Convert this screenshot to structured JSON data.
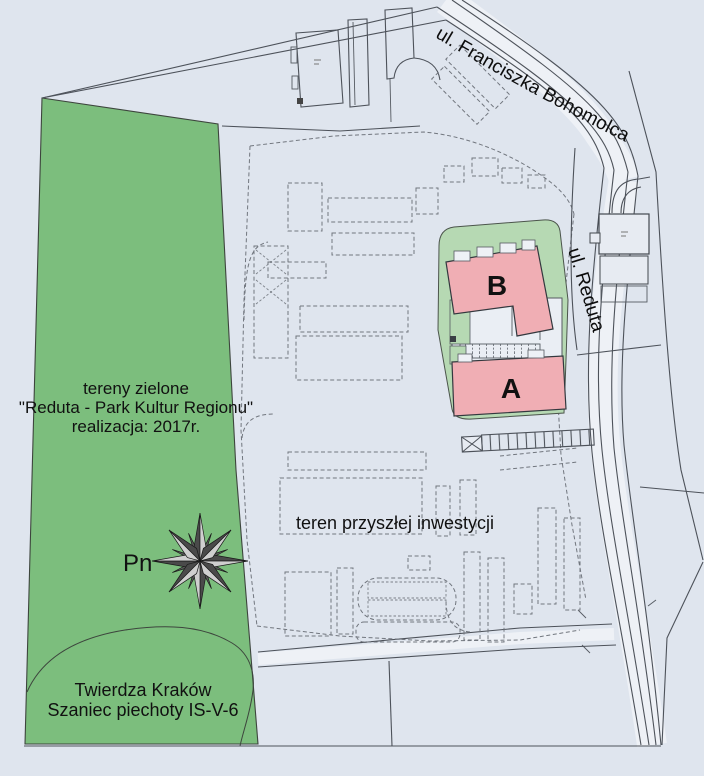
{
  "map": {
    "streets": {
      "bohomolca": "ul. Franciszka  Bohomolca",
      "reduta": "ul. Reduta"
    },
    "park": {
      "line1": "tereny zielone",
      "line2": "\"Reduta - Park Kultur Regionu\"",
      "line3": "realizacja: 2017r."
    },
    "fort": {
      "line1": "Twierdza Kraków",
      "line2": "Szaniec piechoty IS-V-6"
    },
    "future_area": {
      "label": "teren przyszłej inwestycji"
    },
    "buildings": {
      "a": "A",
      "b": "B"
    },
    "compass": {
      "north_label": "Pn"
    },
    "colors": {
      "background": "#dfe5ee",
      "park_green": "#7cbe7d",
      "landscape_green": "#b6d9b3",
      "building_pink": "#f0aeb4",
      "line": "#4d525a"
    }
  }
}
